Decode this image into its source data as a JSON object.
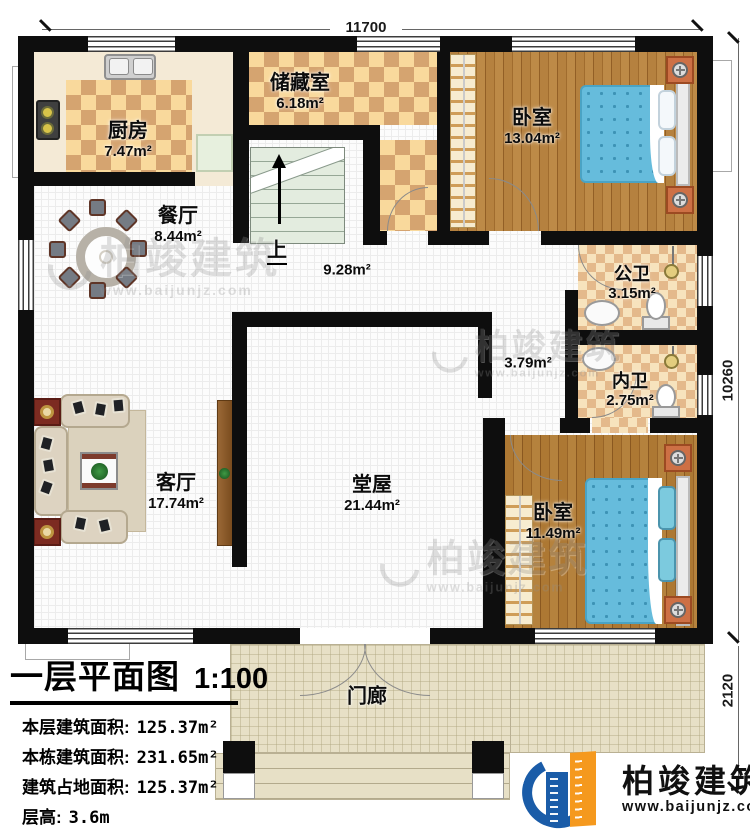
{
  "plan": {
    "title": "一层平面图",
    "scale": "1:100",
    "dimensions": {
      "top": "11700",
      "right_upper": "10260",
      "right_lower": "2120"
    },
    "stats": [
      {
        "label": "本层建筑面积:",
        "value": "125.37m²"
      },
      {
        "label": "本栋建筑面积:",
        "value": "231.65m²"
      },
      {
        "label": "建筑占地面积:",
        "value": "125.37m²"
      },
      {
        "label": "层高:",
        "value": "3.6m"
      }
    ]
  },
  "rooms": {
    "kitchen": {
      "name": "厨房",
      "area": "7.47m²"
    },
    "dining": {
      "name": "餐厅",
      "area": "8.44m²"
    },
    "storage": {
      "name": "储藏室",
      "area": "6.18m²"
    },
    "bedroom_top": {
      "name": "卧室",
      "area": "13.04m²"
    },
    "public_bath": {
      "name": "公卫",
      "area": "3.15m²"
    },
    "ensuite_bath": {
      "name": "内卫",
      "area": "2.75m²"
    },
    "living": {
      "name": "客厅",
      "area": "17.74m²"
    },
    "hall": {
      "name": "堂屋",
      "area": "21.44m²"
    },
    "bedroom_bottom": {
      "name": "卧室",
      "area": "11.49m²"
    },
    "porch": {
      "name": "门廊"
    },
    "stairs": {
      "up": "上",
      "area": "9.28m²"
    },
    "corridor": {
      "area": "3.79m²"
    }
  },
  "branding": {
    "company": "柏竣建筑",
    "website": "www.baijunjz.com"
  },
  "colors": {
    "wall": "#0e0e0e",
    "logo_blue": "#1a5ca8",
    "logo_orange": "#f5991e",
    "bed": "#66bcdc",
    "check_light": "#f9d99c",
    "check_dark": "#d5a470"
  }
}
